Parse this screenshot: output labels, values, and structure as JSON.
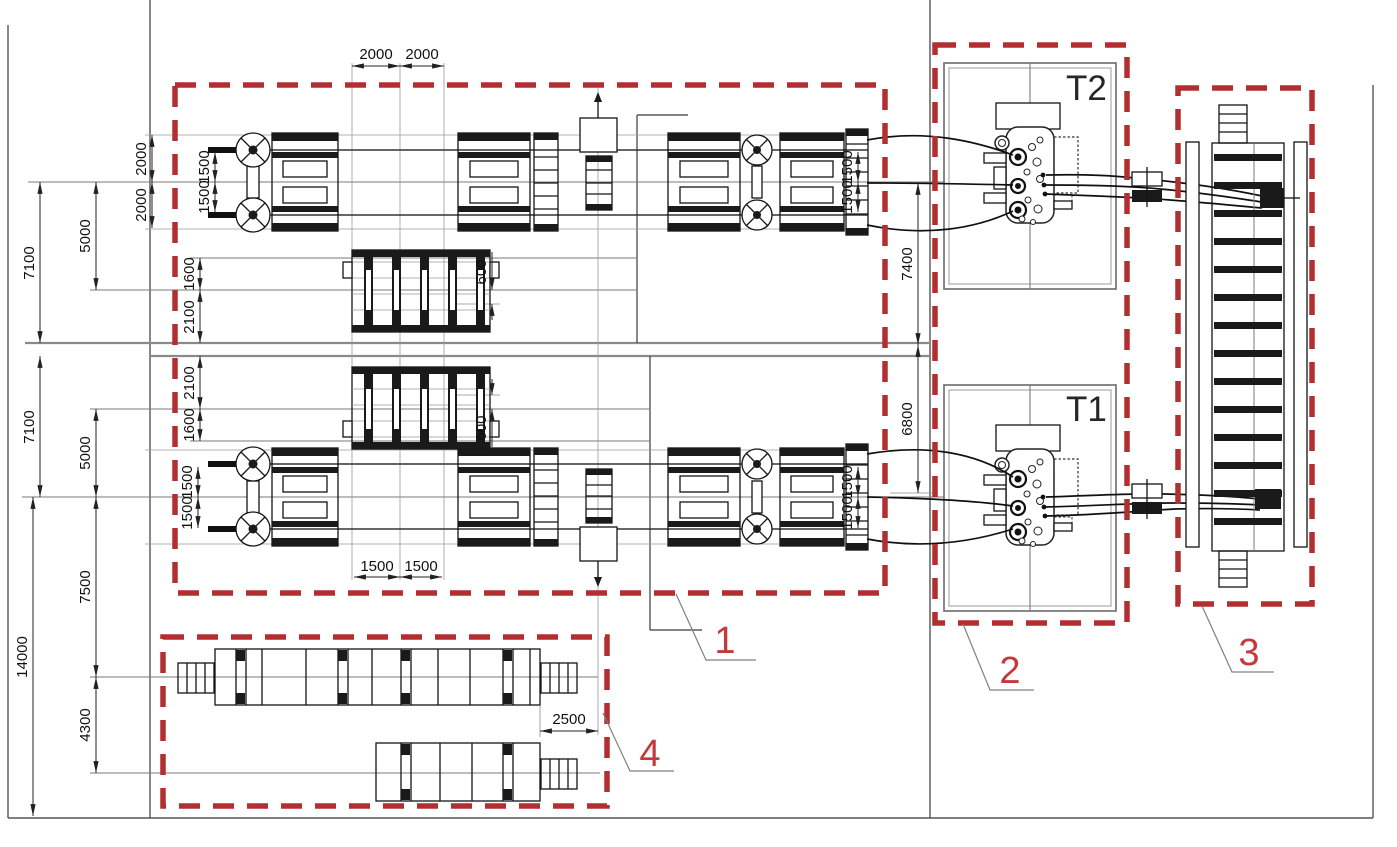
{
  "drawing": {
    "zones": {
      "zone1": "1",
      "zone2": "2",
      "zone3": "3",
      "zone4": "4"
    },
    "transformers": {
      "t2": "T2",
      "t1": "T1"
    },
    "dims": {
      "top_a": "2000",
      "top_b": "2000",
      "bot_a": "1500",
      "bot_b": "1500",
      "walkway_offset": "2500",
      "row_tl_2000_a": "2000",
      "row_tl_2000_b": "2000",
      "row_tl_1500_a": "1500",
      "row_tl_1500_b": "1500",
      "left_7100_u": "7100",
      "left_5000_u": "5000",
      "mid_1600_u": "1600",
      "mid_2100_u": "2100",
      "mid_2100_l": "2100",
      "mid_1600_l": "1600",
      "off_600_u": "600",
      "off_600_l": "600",
      "left_7100_l": "7100",
      "left_5000_l": "5000",
      "row_bl_1500_a": "1500",
      "row_bl_1500_b": "1500",
      "left_7500": "7500",
      "left_14000": "14000",
      "left_4300": "4300",
      "row_tr_1500_a": "1500",
      "row_tr_1500_b": "1500",
      "row_br_1500_a": "1500",
      "row_br_1500_b": "1500",
      "right_7400": "7400",
      "right_6800": "6800"
    },
    "colors": {
      "zone_border": "#b22e31",
      "zone_label": "#c4393c",
      "equipment_line": "#141414",
      "axis_line": "#7a7a7a",
      "dimension": "#222222",
      "background": "#ffffff"
    }
  }
}
